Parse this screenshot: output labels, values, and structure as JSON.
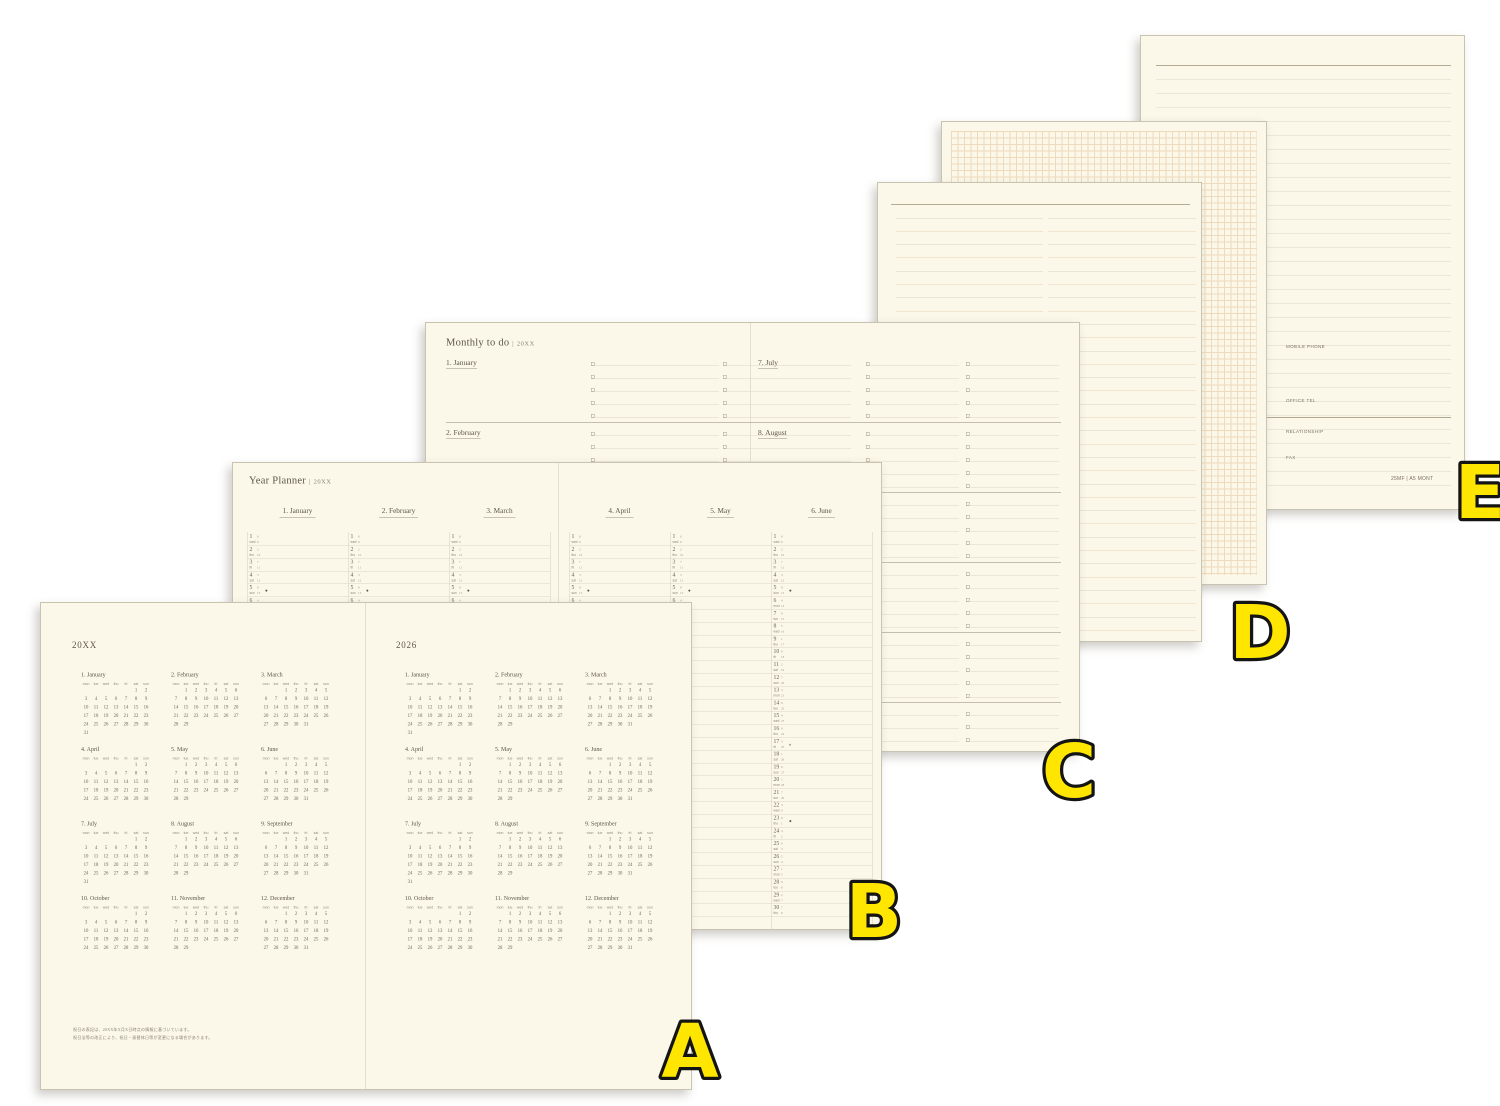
{
  "colors": {
    "paper": "#fbf7e9",
    "ink": "#6a6254",
    "accent_red": "#cf7b50",
    "line_gray": "#dcd5c2",
    "line_orange": "#e9d2b3",
    "grid_orange": "#efdabb",
    "label_fill": "#ffe600",
    "label_stroke": "#141414"
  },
  "overlay": {
    "letters": [
      "A",
      "B",
      "C",
      "D",
      "E"
    ]
  },
  "spread_a": {
    "left_title": "20XX",
    "right_title": "2026",
    "weekday_header": [
      "mon",
      "tue",
      "wed",
      "thu",
      "fri",
      "sat",
      "sun"
    ],
    "months": [
      {
        "label": "1. January",
        "weeks": [
          [
            "",
            "",
            "",
            "",
            "",
            "1",
            "2"
          ],
          [
            "3",
            "4",
            "5",
            "6",
            "7",
            "8",
            "9"
          ],
          [
            "10",
            "11",
            "12",
            "13",
            "14",
            "15",
            "16"
          ],
          [
            "17",
            "18",
            "19",
            "20",
            "21",
            "22",
            "23"
          ],
          [
            "24",
            "25",
            "26",
            "27",
            "28",
            "29",
            "30"
          ],
          [
            "31",
            "",
            "",
            "",
            "",
            "",
            ""
          ]
        ]
      },
      {
        "label": "2. February",
        "weeks": [
          [
            "",
            "1",
            "2",
            "3",
            "4",
            "5",
            "6"
          ],
          [
            "7",
            "8",
            "9",
            "10",
            "11",
            "12",
            "13"
          ],
          [
            "14",
            "15",
            "16",
            "17",
            "18",
            "19",
            "20"
          ],
          [
            "21",
            "22",
            "23",
            "24",
            "25",
            "26",
            "27"
          ],
          [
            "28",
            "29",
            "",
            "",
            "",
            "",
            ""
          ]
        ]
      },
      {
        "label": "3. March",
        "weeks": [
          [
            "",
            "",
            "1",
            "2",
            "3",
            "4",
            "5"
          ],
          [
            "6",
            "7",
            "8",
            "9",
            "10",
            "11",
            "12"
          ],
          [
            "13",
            "14",
            "15",
            "16",
            "17",
            "18",
            "19"
          ],
          [
            "20",
            "21",
            "22",
            "23",
            "24",
            "25",
            "26"
          ],
          [
            "27",
            "28",
            "29",
            "30",
            "31",
            "",
            ""
          ]
        ]
      },
      {
        "label": "4. April",
        "weeks": [
          [
            "",
            "",
            "",
            "",
            "",
            "1",
            "2"
          ],
          [
            "3",
            "4",
            "5",
            "6",
            "7",
            "8",
            "9"
          ],
          [
            "10",
            "11",
            "12",
            "13",
            "14",
            "15",
            "16"
          ],
          [
            "17",
            "18",
            "19",
            "20",
            "21",
            "22",
            "23"
          ],
          [
            "24",
            "25",
            "26",
            "27",
            "28",
            "29",
            "30"
          ]
        ]
      },
      {
        "label": "5. May",
        "weeks": [
          [
            "",
            "1",
            "2",
            "3",
            "4",
            "5",
            "6"
          ],
          [
            "7",
            "8",
            "9",
            "10",
            "11",
            "12",
            "13"
          ],
          [
            "14",
            "15",
            "16",
            "17",
            "18",
            "19",
            "20"
          ],
          [
            "21",
            "22",
            "23",
            "24",
            "25",
            "26",
            "27"
          ],
          [
            "28",
            "29",
            "",
            "",
            "",
            "",
            ""
          ]
        ]
      },
      {
        "label": "6. June",
        "weeks": [
          [
            "",
            "",
            "1",
            "2",
            "3",
            "4",
            "5"
          ],
          [
            "6",
            "7",
            "8",
            "9",
            "10",
            "11",
            "12"
          ],
          [
            "13",
            "14",
            "15",
            "16",
            "17",
            "18",
            "19"
          ],
          [
            "20",
            "21",
            "22",
            "23",
            "24",
            "25",
            "26"
          ],
          [
            "27",
            "28",
            "29",
            "30",
            "31",
            "",
            ""
          ]
        ]
      },
      {
        "label": "7. July",
        "weeks": [
          [
            "",
            "",
            "",
            "",
            "",
            "1",
            "2"
          ],
          [
            "3",
            "4",
            "5",
            "6",
            "7",
            "8",
            "9"
          ],
          [
            "10",
            "11",
            "12",
            "13",
            "14",
            "15",
            "16"
          ],
          [
            "17",
            "18",
            "19",
            "20",
            "21",
            "22",
            "23"
          ],
          [
            "24",
            "25",
            "26",
            "27",
            "28",
            "29",
            "30"
          ],
          [
            "31",
            "",
            "",
            "",
            "",
            "",
            ""
          ]
        ]
      },
      {
        "label": "8. August",
        "weeks": [
          [
            "",
            "1",
            "2",
            "3",
            "4",
            "5",
            "6"
          ],
          [
            "7",
            "8",
            "9",
            "10",
            "11",
            "12",
            "13"
          ],
          [
            "14",
            "15",
            "16",
            "17",
            "18",
            "19",
            "20"
          ],
          [
            "21",
            "22",
            "23",
            "24",
            "25",
            "26",
            "27"
          ],
          [
            "28",
            "29",
            "",
            "",
            "",
            "",
            ""
          ]
        ]
      },
      {
        "label": "9. September",
        "weeks": [
          [
            "",
            "",
            "1",
            "2",
            "3",
            "4",
            "5"
          ],
          [
            "6",
            "7",
            "8",
            "9",
            "10",
            "11",
            "12"
          ],
          [
            "13",
            "14",
            "15",
            "16",
            "17",
            "18",
            "19"
          ],
          [
            "20",
            "21",
            "22",
            "23",
            "24",
            "25",
            "26"
          ],
          [
            "27",
            "28",
            "29",
            "30",
            "31",
            "",
            ""
          ]
        ]
      },
      {
        "label": "10. October",
        "weeks": [
          [
            "",
            "",
            "",
            "",
            "",
            "1",
            "2"
          ],
          [
            "3",
            "4",
            "5",
            "6",
            "7",
            "8",
            "9"
          ],
          [
            "10",
            "11",
            "12",
            "13",
            "14",
            "15",
            "16"
          ],
          [
            "17",
            "18",
            "19",
            "20",
            "21",
            "22",
            "23"
          ],
          [
            "24",
            "25",
            "26",
            "27",
            "28",
            "29",
            "30"
          ]
        ]
      },
      {
        "label": "11. November",
        "weeks": [
          [
            "",
            "1",
            "2",
            "3",
            "4",
            "5",
            "6"
          ],
          [
            "7",
            "8",
            "9",
            "10",
            "11",
            "12",
            "13"
          ],
          [
            "14",
            "15",
            "16",
            "17",
            "18",
            "19",
            "20"
          ],
          [
            "21",
            "22",
            "23",
            "24",
            "25",
            "26",
            "27"
          ],
          [
            "28",
            "29",
            "",
            "",
            "",
            "",
            ""
          ]
        ]
      },
      {
        "label": "12. December",
        "weeks": [
          [
            "",
            "",
            "1",
            "2",
            "3",
            "4",
            "5"
          ],
          [
            "6",
            "7",
            "8",
            "9",
            "10",
            "11",
            "12"
          ],
          [
            "13",
            "14",
            "15",
            "16",
            "17",
            "18",
            "19"
          ],
          [
            "20",
            "21",
            "22",
            "23",
            "24",
            "25",
            "26"
          ],
          [
            "27",
            "28",
            "29",
            "30",
            "31",
            "",
            ""
          ]
        ]
      }
    ],
    "footnotes": [
      "祝日の表記は、20XX年X月X日時点の情報に基づいています。",
      "祝日法等の改正により、祝日・振替休日等が変更になる場合があります。"
    ]
  },
  "spread_b": {
    "title": "Year Planner",
    "divider": "|",
    "year": "20XX",
    "weekday_cycle": [
      "wed",
      "thu",
      "fri",
      "sat",
      "sun",
      "mon",
      "tue"
    ],
    "moon_days": {
      "5": "●",
      "17": "◐",
      "23": "●"
    },
    "columns_left": [
      {
        "label": "1. January",
        "days": 31
      },
      {
        "label": "2. February",
        "days": 29
      },
      {
        "label": "3. March",
        "days": 31
      }
    ],
    "columns_right": [
      {
        "label": "4. April",
        "days": 30
      },
      {
        "label": "5. May",
        "days": 31
      },
      {
        "label": "6. June",
        "days": 30
      }
    ]
  },
  "spread_c": {
    "title": "Monthly to do",
    "divider": "|",
    "year": "20XX",
    "checkbox": "□",
    "rows_per_month": 5,
    "columns_per_month": 2,
    "left_months": [
      "1. January",
      "2. February",
      "3. March",
      "4. April",
      "5. May",
      "6. June"
    ],
    "right_months": [
      "7. July",
      "8. August",
      "9. September",
      "10. October",
      "11. November",
      "12. December"
    ]
  },
  "page_e": {
    "fields": [
      "MOBILE PHONE",
      "OFFICE TEL",
      "RELATIONSHIP",
      "FAX"
    ],
    "footer": "25MF | A5 MONT"
  }
}
